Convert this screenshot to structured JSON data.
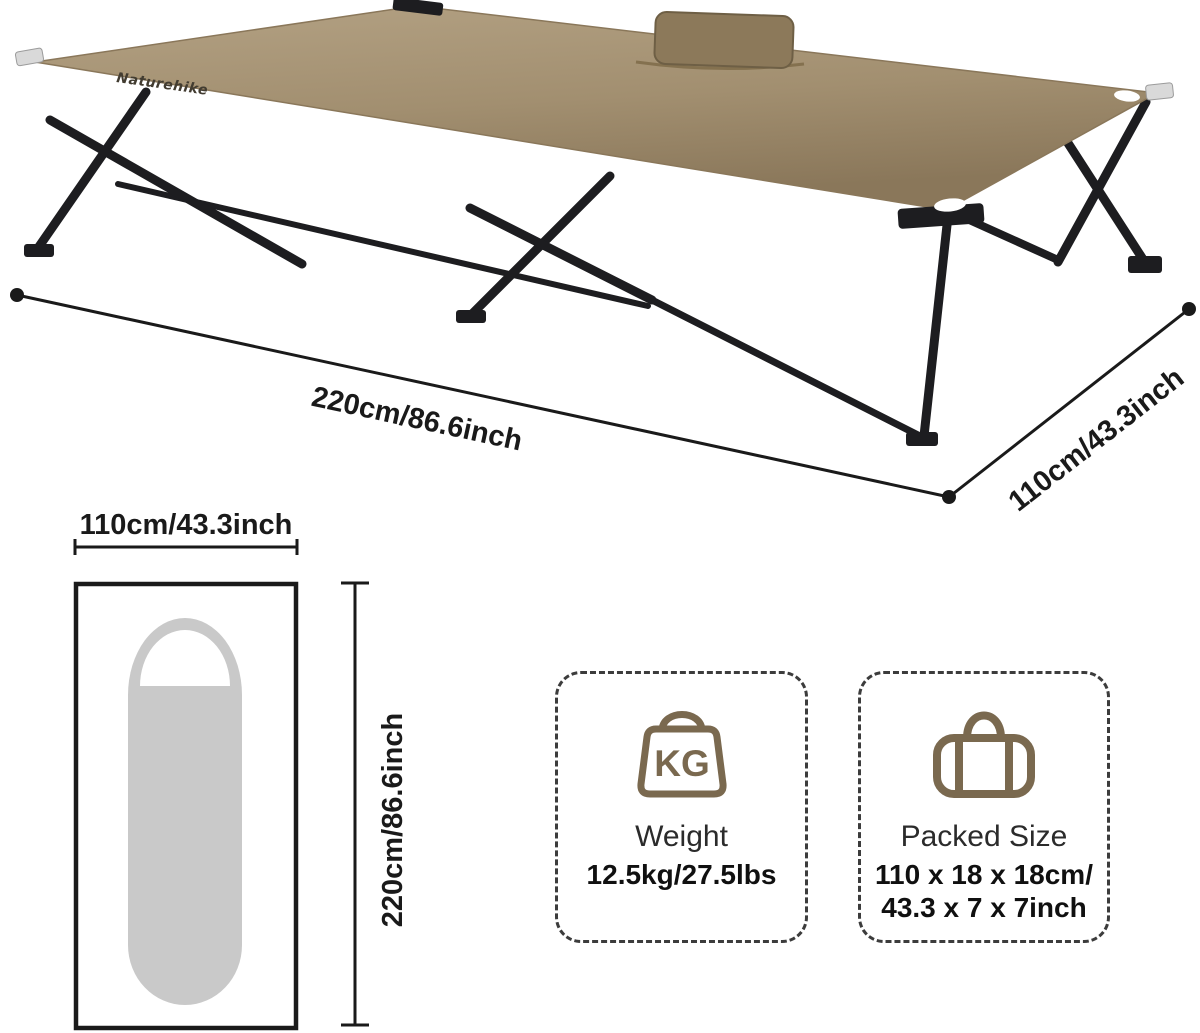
{
  "scene": {
    "brand": "Naturehike",
    "length_label": "220cm/86.6inch",
    "width_label": "110cm/43.3inch"
  },
  "top_view": {
    "width_label": "110cm/43.3inch",
    "length_label": "220cm/86.6inch"
  },
  "cards": {
    "weight": {
      "icon": "kg-weight-bag-icon",
      "icon_text": "KG",
      "title": "Weight",
      "value": "12.5kg/27.5lbs"
    },
    "packed": {
      "icon": "duffel-bag-icon",
      "title": "Packed Size",
      "value_line1": "110 x 18 x 18cm/",
      "value_line2": "43.3 x 7 x 7inch"
    }
  },
  "colors": {
    "fabric_tan": "#a79475",
    "fabric_light": "#b3a183",
    "fabric_dark": "#8a775a",
    "frame_black": "#1d1d20",
    "icon_brown": "#7a694f",
    "silhouette_gray": "#c9c9c9",
    "annotation_black": "#1a1a1a",
    "card_border_gray": "#3c3c3c",
    "background": "#ffffff"
  }
}
